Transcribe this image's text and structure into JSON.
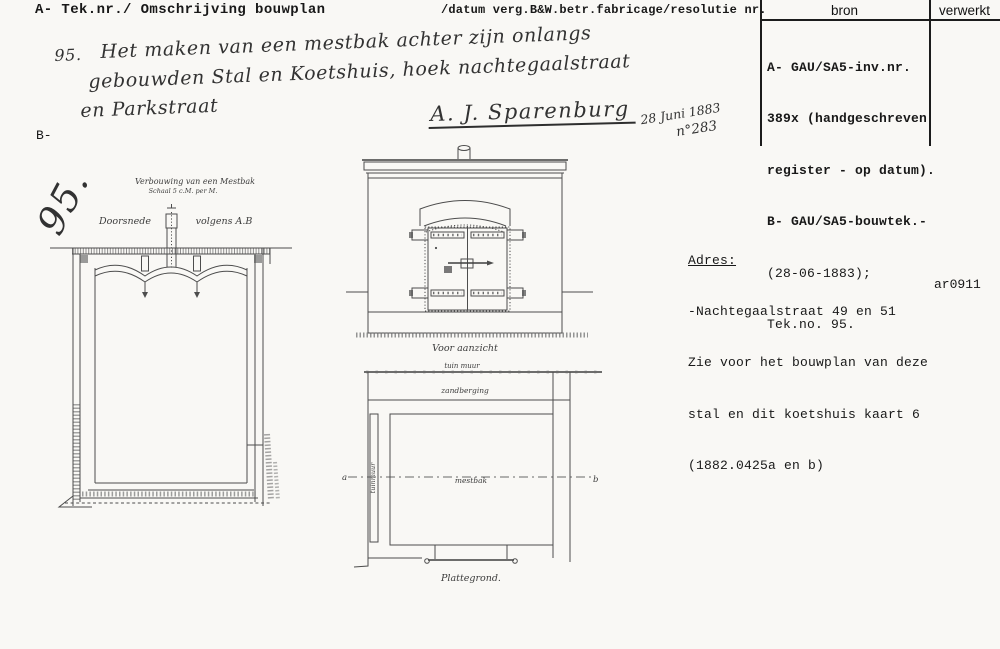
{
  "header": {
    "left": "A- Tek.nr./ Omschrijving bouwplan",
    "right": "/datum verg.B&W.betr.fabricage/resolutie nr."
  },
  "source_table": {
    "col_bron": "bron",
    "col_verwerkt": "verwerkt",
    "lines": [
      "A- GAU/SA5-inv.nr.",
      "389x (handgeschreven",
      "register - op datum).",
      "B- GAU/SA5-bouwtek.-",
      "(28-06-1883);",
      "Tek.no. 95."
    ]
  },
  "handwritten": {
    "item_number": "95.",
    "description_line1": "Het maken van een mestbak achter zijn onlangs",
    "description_line2": "gebouwden Stal en Koetshuis, hoek nachtegaalstraat",
    "description_line3": "en Parkstraat",
    "signature": "A. J. Sparenburg",
    "date": "28 Juni 1883",
    "resolution_number": "n°283"
  },
  "margin": {
    "b_label": "B-",
    "drawing_number": "95."
  },
  "address": {
    "title": "Adres:",
    "line1": "-Nachtegaalstraat 49 en 51",
    "line2": "Zie voor het bouwplan van deze",
    "line3": "stal en dit koetshuis kaart 6",
    "line4": "(1882.0425a en b)",
    "code": "ar0911"
  },
  "drawings": {
    "section": {
      "title": "Verbouwing van een Mestbak",
      "scale": "Schaal 5 c.M. per M.",
      "label_view": "Doorsnede",
      "label_ref": "volgens A.B"
    },
    "front": {
      "caption": "Voor aanzicht"
    },
    "plan": {
      "caption": "Plattegrond.",
      "label_top_wall": "tuin muur",
      "label_sand": "zandberging",
      "label_left_wall": "tuinmuur",
      "label_center": "mestbak",
      "marker_a": "a",
      "marker_b": "b"
    }
  }
}
